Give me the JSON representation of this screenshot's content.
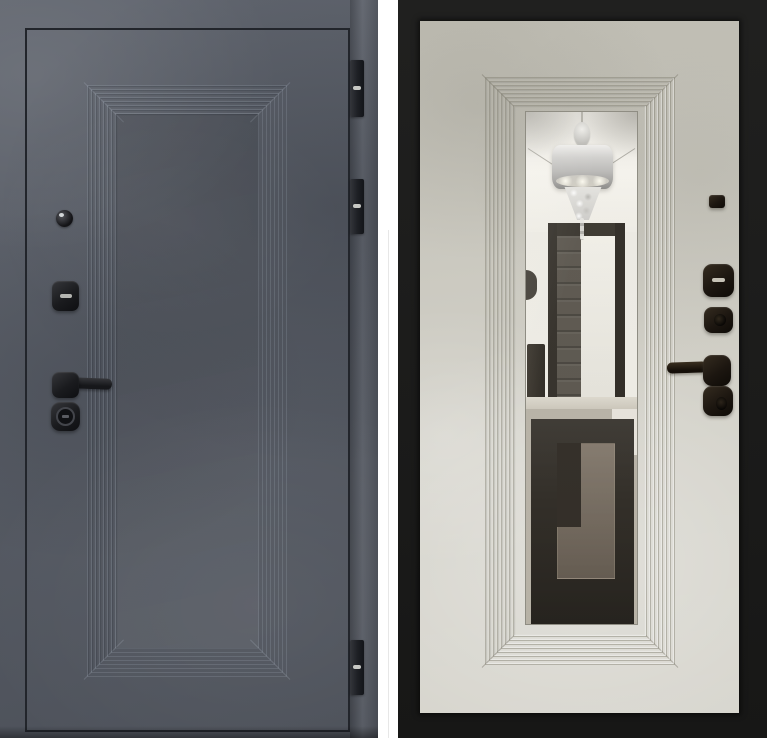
{
  "photo": {
    "label": "steel-entry-door-two-sides",
    "left_side": {
      "view": "exterior",
      "features": [
        "stepped-panel-molding",
        "peephole",
        "upper-lock-escutcheon",
        "lever-handle",
        "cylinder-thumbturn",
        "three-hinges"
      ]
    },
    "right_side": {
      "view": "interior",
      "features": [
        "black-door-frame",
        "stepped-mirror-molding",
        "full-length-mirror",
        "peephole-cover",
        "thumbturn-escutcheon",
        "cylinder-escutcheon",
        "lever-handle",
        "lower-lock-escutcheon"
      ],
      "mirror_reflection": [
        "white-ceiling",
        "drum-chandelier",
        "open-dark-doorway",
        "wall-sconce",
        "console-cabinet",
        "dark-carpet-with-key-pattern"
      ]
    },
    "colors": {
      "background": "#ffffff",
      "exterior_surface": "#565b65",
      "exterior_outline": "#22252b",
      "exterior_hardware": "#1a1b1e",
      "interior_frame": "#191918",
      "interior_surface": "#cbc9bf",
      "interior_hardware": "#1c1610",
      "mirror_wall": "#efede6",
      "mirror_ceiling": "#f8f6f0",
      "mirror_doorframe": "#36322b",
      "mirror_door_dark": "#59544c",
      "mirror_floor_dark": "#2e2a24",
      "mirror_floor_inner": "#786d60",
      "chandelier_silver": "#bbbab8"
    }
  }
}
